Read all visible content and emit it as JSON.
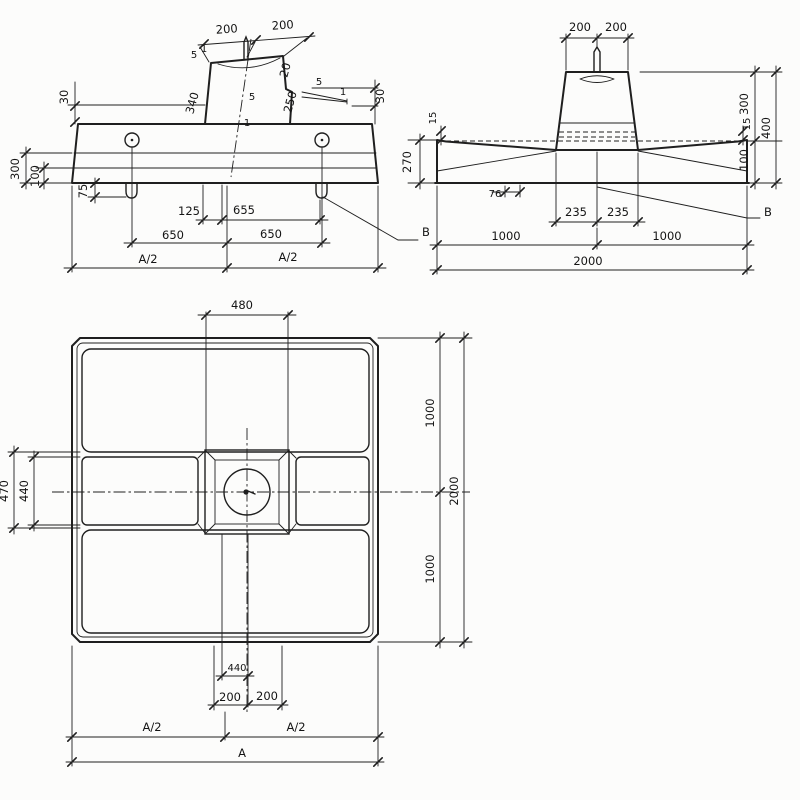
{
  "sheet": {
    "background": "#fcfcfb",
    "ink": "#1f1f1f"
  },
  "front": {
    "dim_top_left": "200",
    "dim_top_right": "200",
    "dim_lip_left": "30",
    "dim_lip_right": "30",
    "dim_pedestal_left_face": "340",
    "dim_pedestal_right_face": "250",
    "dim_step": "20",
    "slope_run": "5",
    "slope_rise": "1",
    "dim_edge_total": "300",
    "dim_edge_chamfer": "100",
    "dim_loop_drop": "75",
    "dim_offset_left": "125",
    "dim_offset_right": "655",
    "dim_half_span_left": "650",
    "dim_half_span_right": "650",
    "dim_a_half": "A/2",
    "leader_label": "B"
  },
  "side": {
    "dim_top_left": "200",
    "dim_top_right": "200",
    "dim_lip_left": "15",
    "dim_lip_right": "15",
    "dim_edge_height": "270",
    "dim_pedestal_height": "300",
    "dim_slab_center": "100",
    "dim_total_height": "400",
    "dim_loop_offset": "76",
    "dim_base_left": "235",
    "dim_base_right": "235",
    "dim_half_left": "1000",
    "dim_half_right": "1000",
    "dim_width": "2000",
    "leader_label": "B"
  },
  "plan": {
    "dim_pedestal_width": "480",
    "dim_band_outer": "470",
    "dim_band_inner": "440",
    "dim_half_top": "1000",
    "dim_half_bottom": "1000",
    "dim_depth": "2000",
    "dim_bolt": "440",
    "dim_left_200": "200",
    "dim_right_200": "200",
    "dim_a_half": "A/2",
    "dim_a": "A"
  }
}
